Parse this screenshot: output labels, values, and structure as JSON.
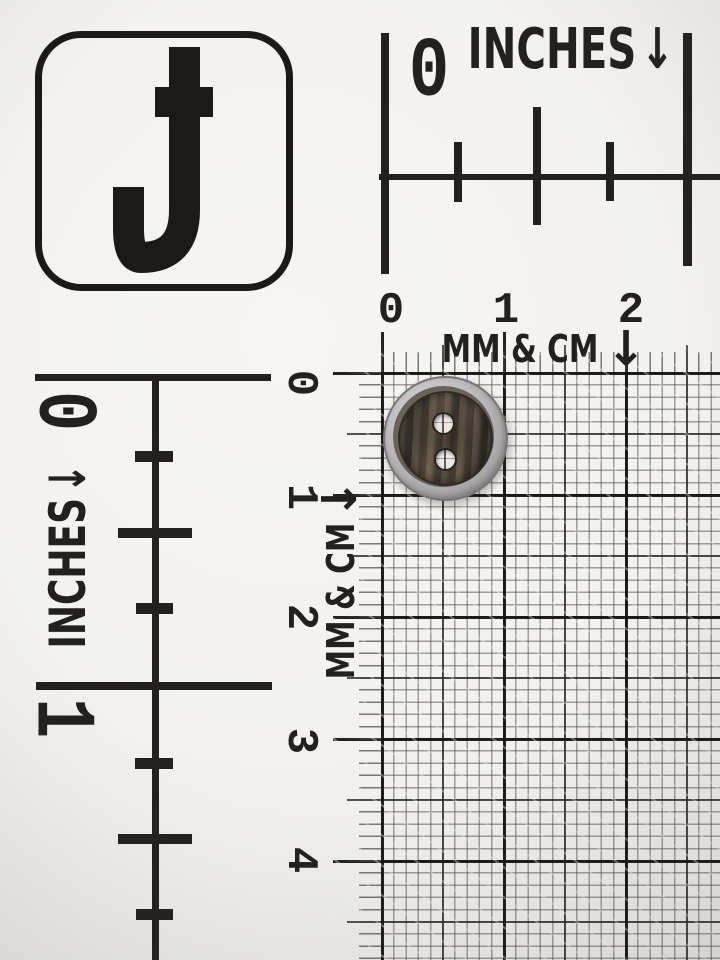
{
  "card": {
    "logo_letter": "J",
    "inch_ruler_top": {
      "zero_label": "0",
      "unit_label": "INCHES",
      "arrow": "↓"
    },
    "inch_ruler_left": {
      "zero_label": "0",
      "one_label": "1",
      "unit_label": "INCHES",
      "arrow": "↓"
    },
    "metric_ruler_top": {
      "numbers": [
        "0",
        "1",
        "2"
      ],
      "unit_label": "MM & CM",
      "arrow": "↓"
    },
    "metric_ruler_left": {
      "numbers": [
        "0",
        "1",
        "2",
        "3",
        "4"
      ],
      "unit_label": "MM & CM",
      "arrow": "↓"
    }
  },
  "subject": {
    "type": "round two-hole button",
    "hole_count": "2"
  },
  "colors": {
    "paper": "#f2f1ee",
    "ink": "#23211e",
    "grid_major": "#1c1b19",
    "grid_minor": "#7e7c78",
    "button_rim": "#b5b2b5",
    "button_face": "#46403a",
    "button_hole": "#eceae7"
  }
}
